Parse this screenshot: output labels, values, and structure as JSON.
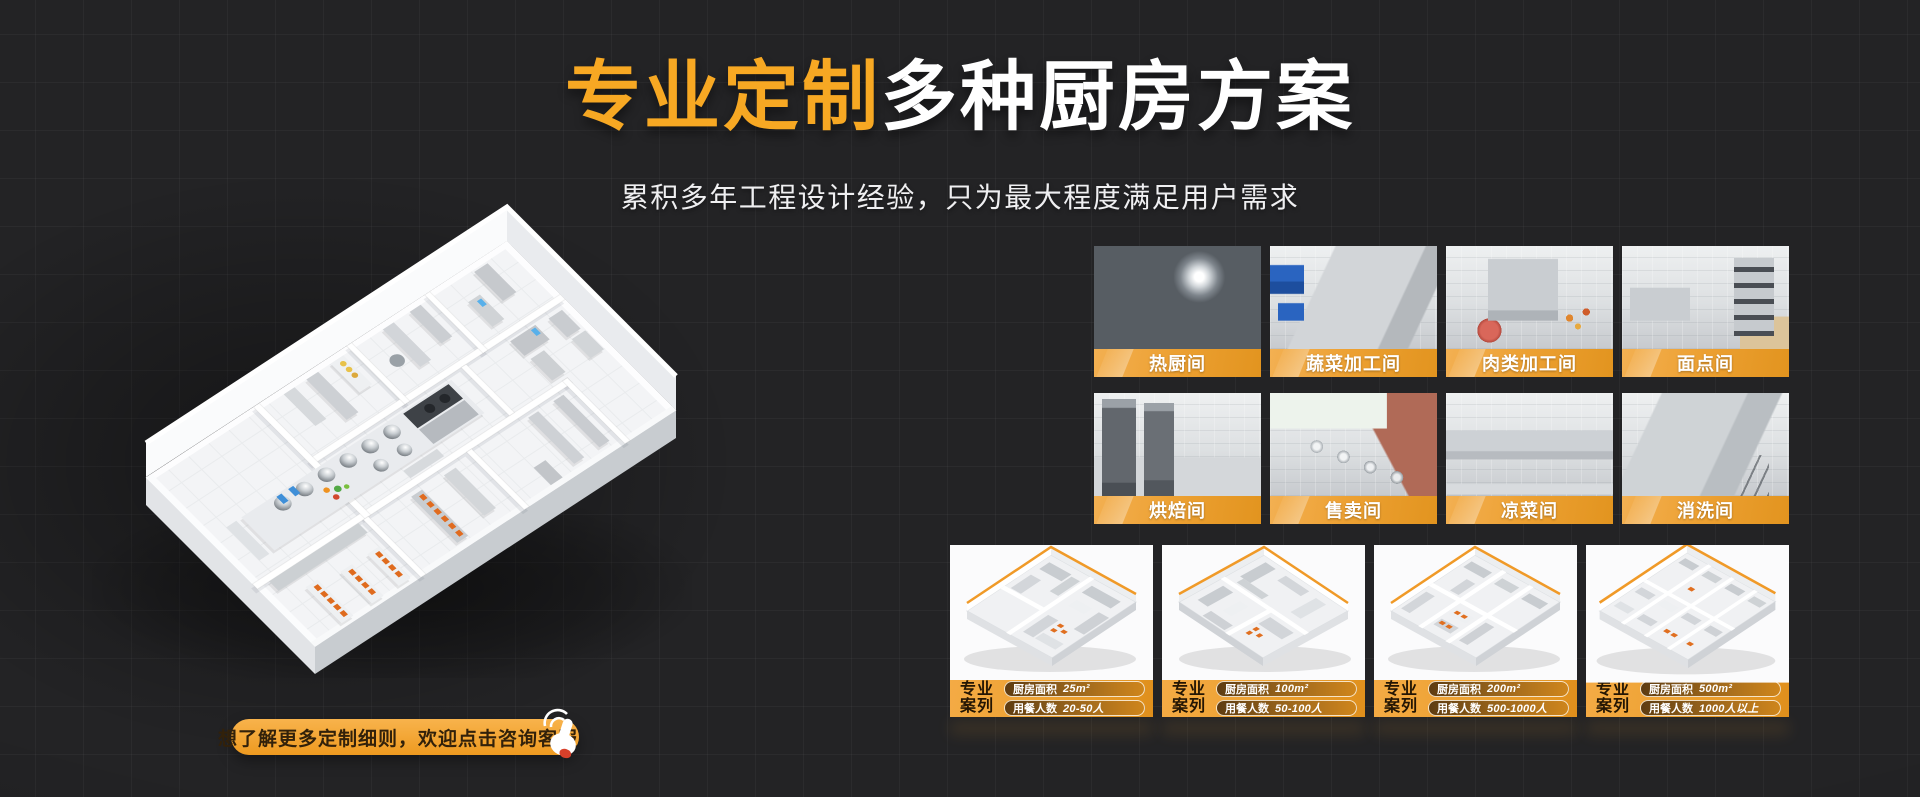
{
  "hero": {
    "title_highlight": "专业定制",
    "title_rest": "多种厨房方案",
    "subtitle": "累积多年工程设计经验，只为最大程度满足用户需求"
  },
  "cta": {
    "label": "想了解更多定制细则，欢迎点击咨询客服"
  },
  "rooms": [
    {
      "label": "热厨间"
    },
    {
      "label": "蔬菜加工间"
    },
    {
      "label": "肉类加工间"
    },
    {
      "label": "面点间"
    },
    {
      "label": "烘焙间"
    },
    {
      "label": "售卖间"
    },
    {
      "label": "凉菜间"
    },
    {
      "label": "消洗间"
    }
  ],
  "cases": [
    {
      "tag": "专业案列",
      "area_label": "厨房面积",
      "area_value": "25m²",
      "capacity_label": "用餐人数",
      "capacity_value": "20-50人"
    },
    {
      "tag": "专业案列",
      "area_label": "厨房面积",
      "area_value": "100m²",
      "capacity_label": "用餐人数",
      "capacity_value": "50-100人"
    },
    {
      "tag": "专业案列",
      "area_label": "厨房面积",
      "area_value": "200m²",
      "capacity_label": "用餐人数",
      "capacity_value": "500-1000人"
    },
    {
      "tag": "专业案列",
      "area_label": "厨房面积",
      "area_value": "500m²",
      "capacity_label": "用餐人数",
      "capacity_value": "1000人以上"
    }
  ],
  "colors": {
    "accent": "#F7A823",
    "accent_deep": "#E08F1D",
    "background": "#232325",
    "text": "#FFFFFF"
  }
}
